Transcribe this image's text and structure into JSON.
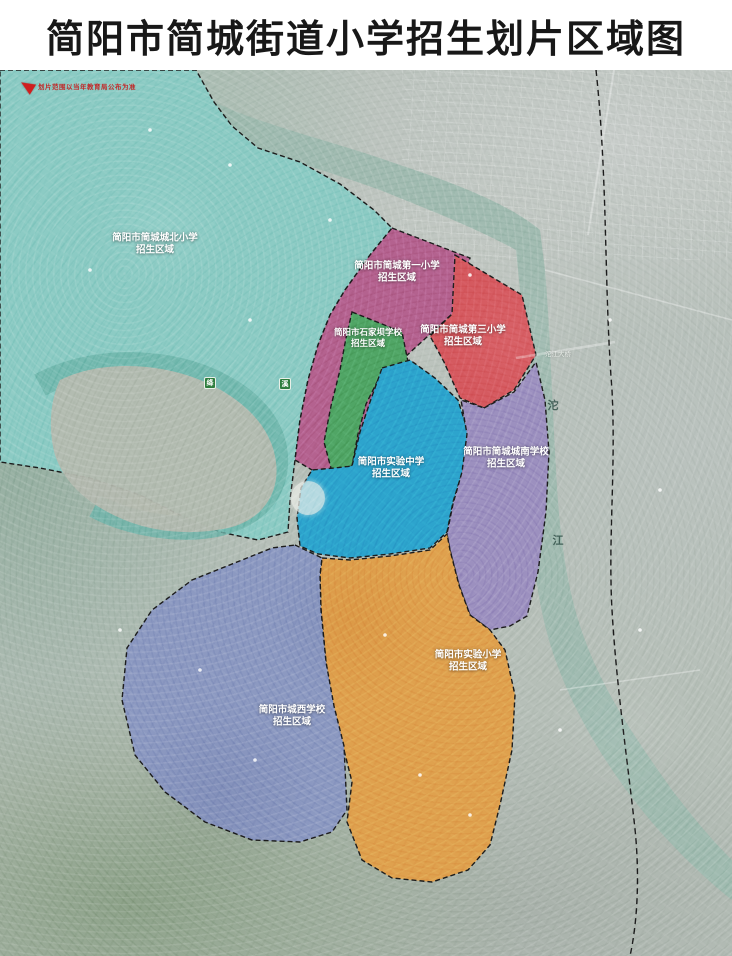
{
  "title": "简阳市简城街道小学招生划片区域图",
  "notice": {
    "text": "划片范围以当年教育局公布为准"
  },
  "zones": [
    {
      "name": "简阳市简城城北小学",
      "sub": "招生区域",
      "color": "#8ccbc4"
    },
    {
      "name": "简阳市简城第一小学",
      "sub": "招生区域",
      "color": "#b4628f"
    },
    {
      "name": "简阳市简城第三小学",
      "sub": "招生区域",
      "color": "#d5595f"
    },
    {
      "name": "简阳市石家坝学校",
      "sub": "招生区域",
      "color": "#50a565"
    },
    {
      "name": "简阳市实验中学",
      "sub": "招生区域",
      "color": "#2da4cd"
    },
    {
      "name": "简阳市简城城南学校",
      "sub": "招生区域",
      "color": "#9c90bf"
    },
    {
      "name": "简阳市实验小学",
      "sub": "招生区域",
      "color": "#dfa14e"
    },
    {
      "name": "简阳市城西学校",
      "sub": "招生区域",
      "color": "#8c99c1"
    }
  ],
  "map_labels": {
    "river_vertical": [
      "沱",
      "江"
    ],
    "bridge": "沱江大桥",
    "road_shields": [
      "绛",
      "溪"
    ]
  },
  "style": {
    "boundary_color": "#1c1c1c",
    "river_color": "#9fbab0",
    "title_color": "#181818",
    "notice_color": "#c42020"
  }
}
